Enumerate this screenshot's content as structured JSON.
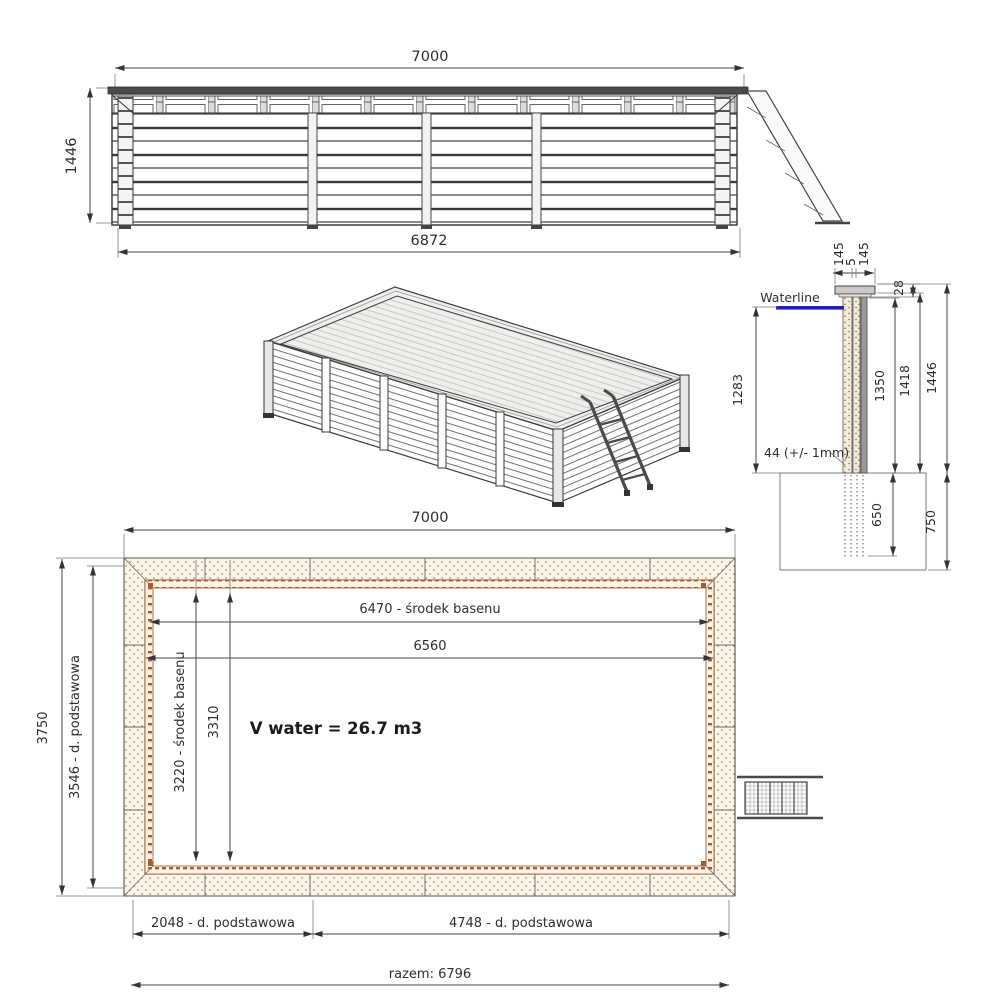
{
  "drawing_type": "wooden pool technical drawing",
  "colors": {
    "line": "#3c3c3c",
    "waterline_blue": "#1f1fbf",
    "hatch_dot": "#b98a54",
    "rust_band": "#b05a2a"
  },
  "elevation": {
    "dim_width_top": "7000",
    "dim_height_left": "1446",
    "dim_width_bottom": "6872"
  },
  "section": {
    "waterline_label": "Waterline",
    "dim_cap_left": "145",
    "dim_cap_gap": "5",
    "dim_cap_right": "145",
    "dim_cap_thickness": "28",
    "dim_water_depth": "1283",
    "dim_inner_height": "1350",
    "dim_wall_height": "1418",
    "dim_total_height": "1446",
    "dim_plank_note": "44 (+/- 1mm)",
    "dim_embed_depth": "650",
    "dim_foundation_depth": "750"
  },
  "plan": {
    "dim_width_top": "7000",
    "dim_height_outer": "3750",
    "dim_height_base": "3546 - d. podstawowa",
    "dim_inner_center_w": "6470 - środek basenu",
    "dim_inner_width": "6560",
    "dim_inner_center_h": "3220 - środek basenu",
    "dim_inner_height": "3310",
    "volume_label": "V water = 26.7 m3",
    "dim_base_left": "2048 - d. podstawowa",
    "dim_base_right": "4748 - d. podstawowa",
    "dim_base_total": "razem: 6796"
  }
}
